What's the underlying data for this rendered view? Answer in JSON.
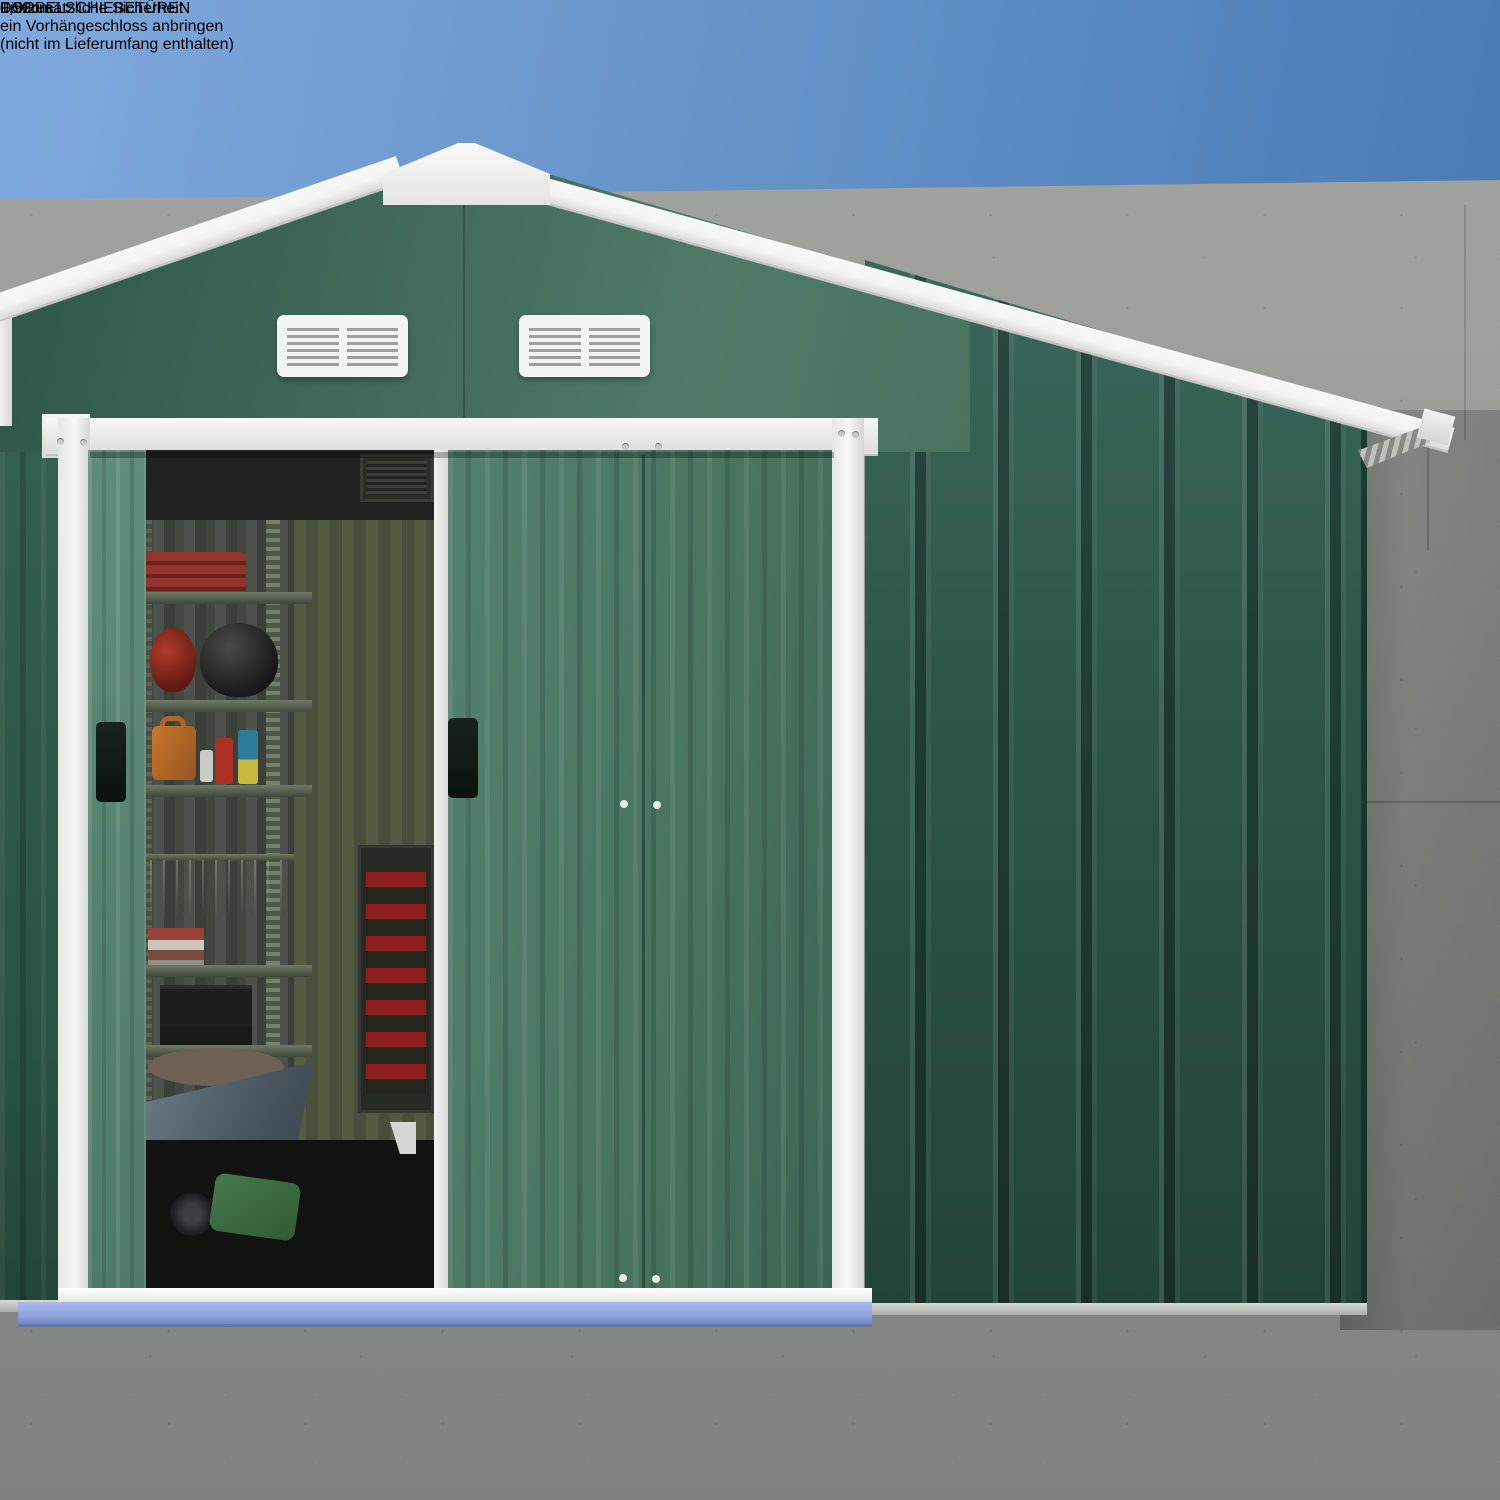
{
  "annotations": {
    "heading": "DOPPELSCHIEBETÜREN",
    "body": [
      "Für zusätzliche Sicherheit",
      "ein Vorhängeschloss anbringen",
      "(nicht im Lieferumfang enthalten)"
    ],
    "door_width_label": "1,52cm",
    "base_width_label": "0,96cm"
  },
  "icons": {
    "direction_arrows": {
      "name": "arrow-right-icon",
      "count": 3,
      "color": "#F5D84E"
    }
  },
  "colors": {
    "sky_top": "#7FA9DD",
    "sky_deep": "#4A7BB5",
    "concrete": "#9B9D99",
    "shed_green_light": "#4E7A67",
    "shed_green_dark": "#2C5547",
    "door_green": "#48745F",
    "trim_white": "#F4F4F2",
    "arrow_yellow": "#F5D84E",
    "threshold_blue": "#8CA0DC",
    "text_white": "#FFFFFF"
  }
}
